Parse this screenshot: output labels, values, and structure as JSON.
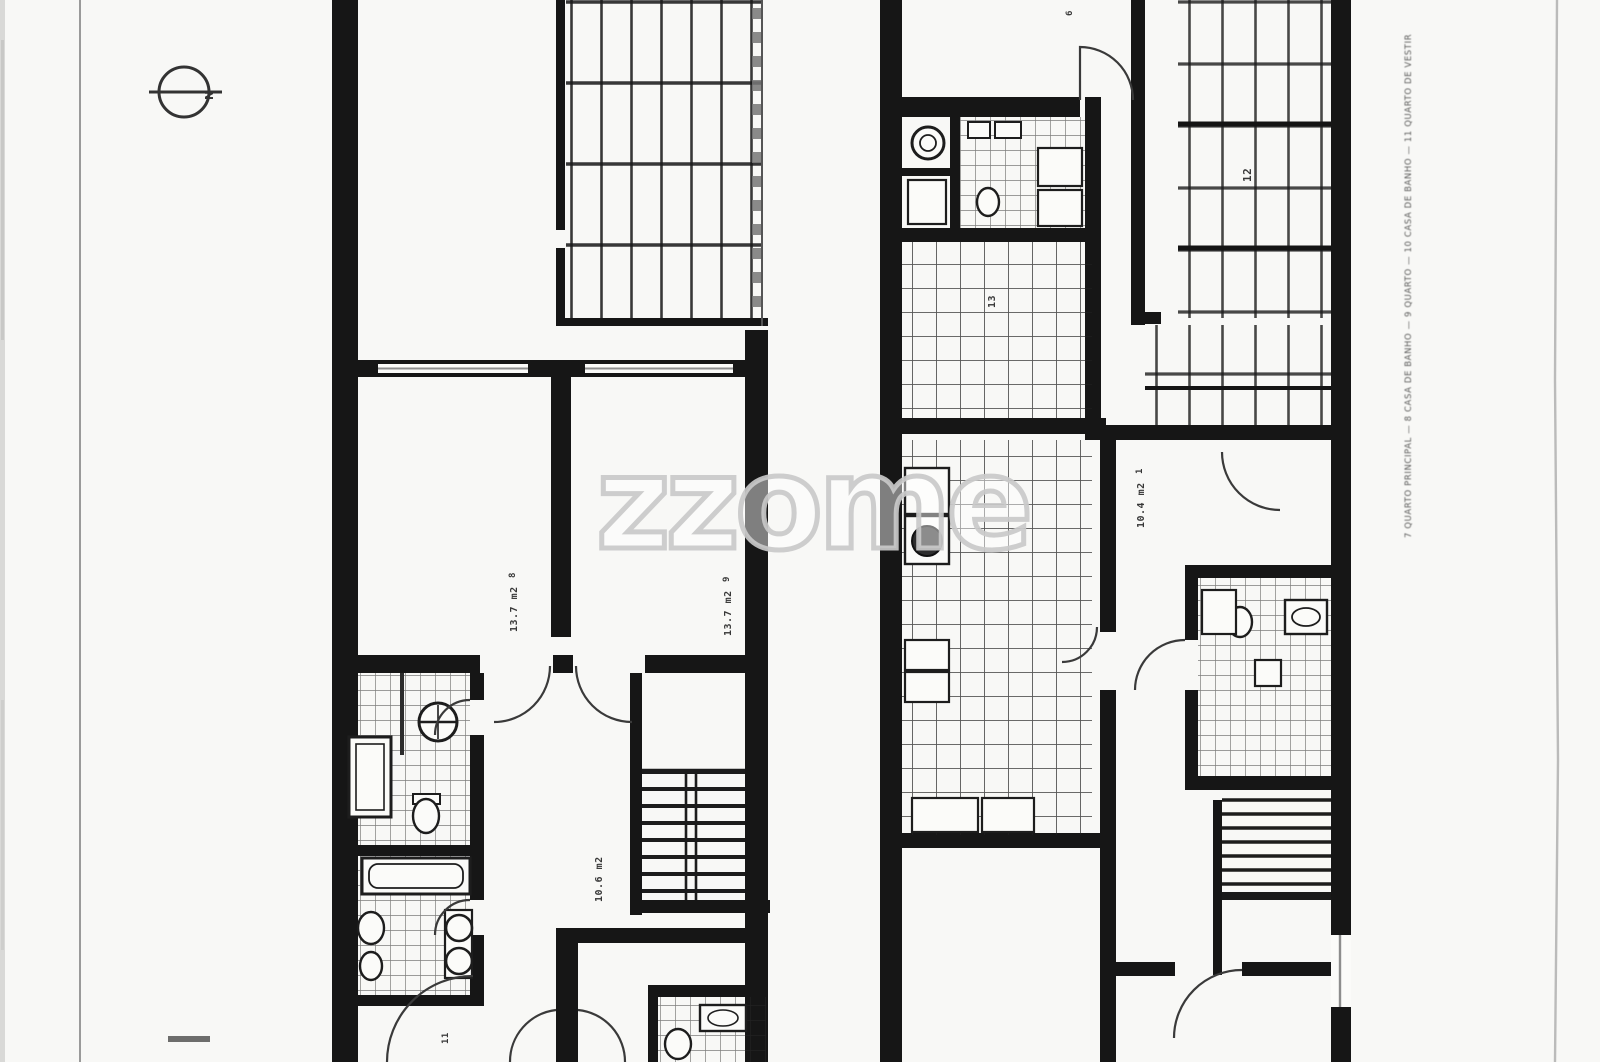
{
  "watermark": {
    "text": "zzome"
  },
  "compass": {
    "north_label": "N"
  },
  "legend": {
    "vertical_text": "7 QUARTO PRINCIPAL — 8 CASA DE BANHO — 9 QUARTO — 10 CASA DE BANHO — 11 QUARTO DE VESTIR"
  },
  "left_plan": {
    "bedroom_left": {
      "number": "8",
      "area": "13.7 m2"
    },
    "bedroom_right": {
      "number": "9",
      "area": "13.7 m2"
    },
    "hall": {
      "area": "10.6 m2"
    },
    "bottom_room": {
      "number": "11"
    }
  },
  "right_plan": {
    "top_room": {
      "number": "6"
    },
    "terrace": {
      "number": "12"
    },
    "tiled_room": {
      "number": "13"
    },
    "bedroom": {
      "number": "1",
      "area": "10.4 m2"
    }
  },
  "colors": {
    "wall": "#161616",
    "tile_line": "#222222",
    "door_arc": "#3a3a3a",
    "watermark_stroke": "#c9c9c9",
    "scan_line": "#8a8a8a",
    "label": "#1d1d1d"
  }
}
